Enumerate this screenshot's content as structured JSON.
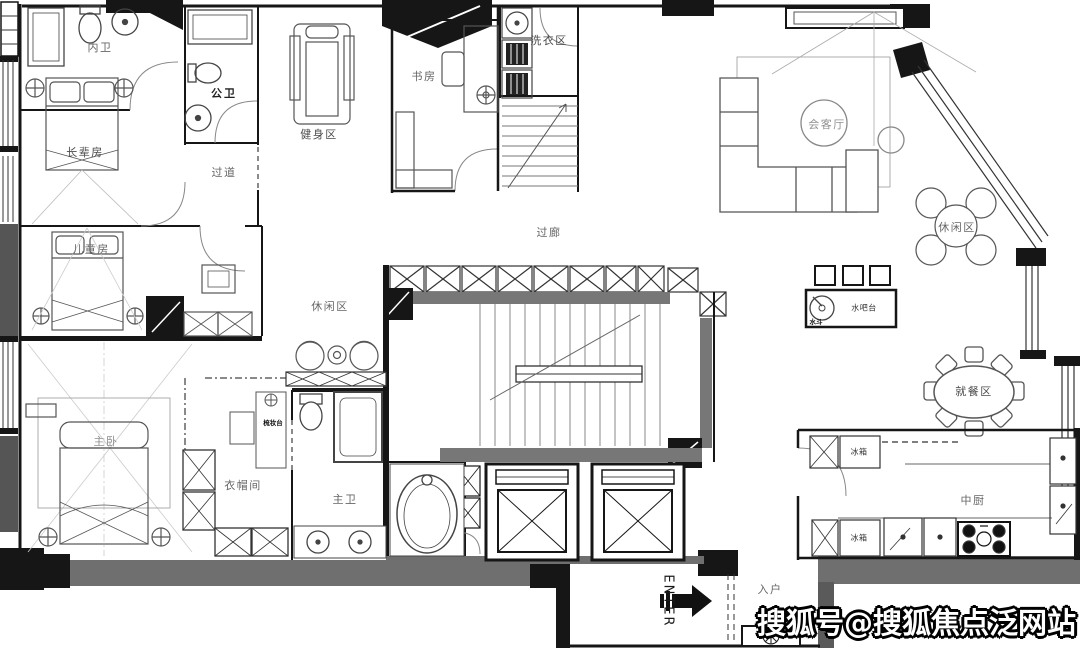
{
  "canvas": {
    "width": 1080,
    "height": 648,
    "background": "#ffffff"
  },
  "colors": {
    "wall_black": "#161616",
    "wall_gray": "#6f6f6f",
    "line_dark": "#333333",
    "line_mid": "#777777",
    "line_light": "#aaaaaa",
    "watermark_fill": "#ffffff",
    "watermark_outline": "#000000"
  },
  "rooms": {
    "inner_bath": "内卫",
    "public_bath": "公卫",
    "elder_room": "长辈房",
    "corridor": "过道",
    "gym": "健身区",
    "study": "书房",
    "laundry": "洗衣区",
    "reception": "会客厅",
    "leisure_right": "休闲区",
    "gallery": "过廊",
    "leisure_left": "休闲区",
    "kids_room": "儿童房",
    "master_bedroom": "主卧",
    "cloakroom": "衣帽间",
    "master_bath": "主卫",
    "dining": "就餐区",
    "kitchen": "中厨",
    "entry": "入户"
  },
  "fixtures": {
    "vanity": "梳妆台",
    "water_bar": "水吧台",
    "sink": "水斗",
    "fridge_top": "冰箱",
    "fridge_bottom": "冰箱"
  },
  "entry_marker": {
    "label": "ENTER",
    "arrow": "right-arrow"
  },
  "watermark": {
    "text": "搜狐号@搜狐焦点泛网站"
  }
}
